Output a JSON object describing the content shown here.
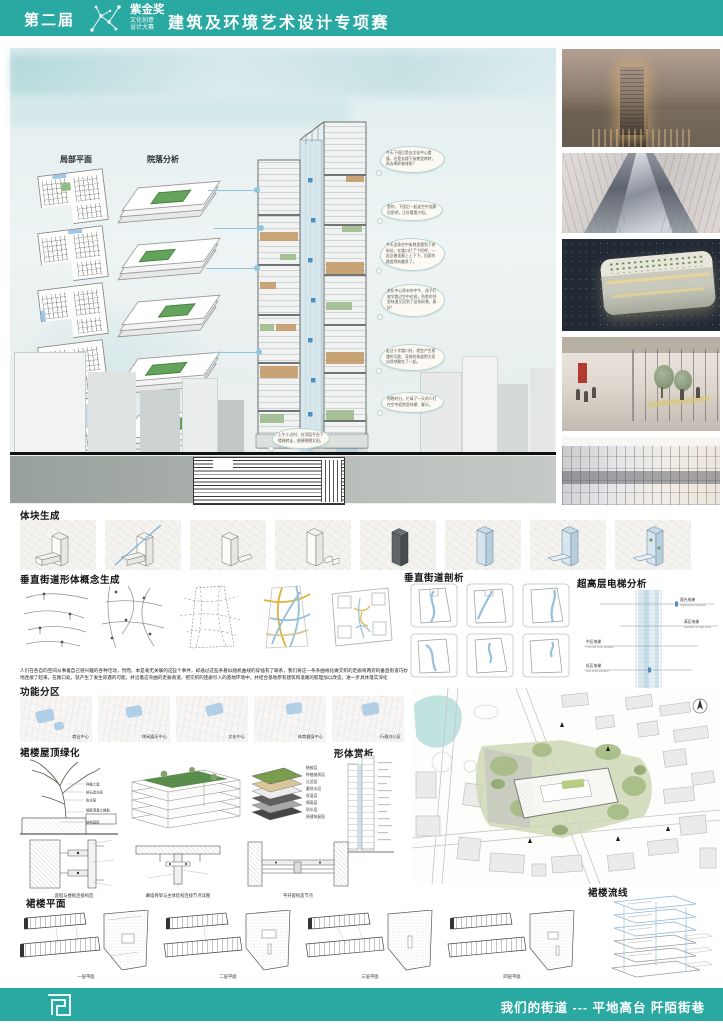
{
  "header": {
    "edition": "第二届",
    "award_name": "紫金奖",
    "award_line1": "文化创意",
    "award_line2": "设计大赛",
    "competition_title": "建筑及环境艺术设计专项赛"
  },
  "board": {
    "partial_plan_label": "局部平面",
    "courtyard_label": "院落分析",
    "bubbles": [
      "今天下班后是去文化中心看展，还是去楼下街巷里转转，再去喝杯咖啡呢？",
      "是的，下班后一起走空中连廊回家吧，正好看看夕阳。",
      "今天这条空中街巷里遇到了老街坊，在路口打了个招呼，一起沿着连廊上上下下，回家的路变得有趣多了。",
      "文化中心周末的中午，孩子们放学路过空中花园，熟悉的邻里味道又回到了这条街巷，真好！",
      "走过十字路口处，就会产生相遇的可能，弯曲的甬道把大家自然地聚在了一起。",
      "傍晚时分，忙碌了一天的人们在空中庭院里休憩、聊天。",
      "上午十点时，在顶层平台下楼梯转走，顺便晒晒太阳。"
    ]
  },
  "massing": {
    "title": "体块生成"
  },
  "concept": {
    "title": "垂直街道形体概念生成"
  },
  "street_section": {
    "title": "垂直街道剖析"
  },
  "elevator": {
    "title": "超高层电梯分析",
    "labels": [
      {
        "cn": "观光电梯",
        "en": "Sightseeing elevator"
      },
      {
        "cn": "高区电梯",
        "en": "Elevator for high zone"
      },
      {
        "cn": "中区电梯",
        "en": "The mid zone elevator"
      },
      {
        "cn": "低区电梯",
        "en": "Low zone elevator"
      }
    ]
  },
  "narrative": "人们在各自的空间从事着自己感兴趣的各种活动，然而，本是毫无关联的这些个事件，却通过这些条看似随机曲线的穿插有了联系，我们将这一条条曲线化做交织的走廊将两旁的垂直街道巧妙地连接了起来，在路口处，就产生了发生际遇的可能，并沿着这弯曲的走廊甬道，把交织的连廊引入的基地环境中，并结合基地原有建筑和道路的肌理加以改造，进一步具体落实深化",
  "function_zones": {
    "title": "功能分区",
    "zones": [
      "商业中心",
      "休闲娱乐中心",
      "文化中心",
      "体育健身中心",
      "行政办公区"
    ]
  },
  "roof_green": {
    "title": "裙楼屋顶绿化",
    "tree_labels": [
      "种植土壤",
      "卵石滤水层",
      "防水层",
      "钢筋混凝土楼板",
      "结构基层"
    ],
    "layer_labels": [
      "植被层",
      "种植基质层",
      "过滤层",
      "蓄排水层",
      "保温层",
      "隔离层",
      "防水层",
      "原建筑屋面"
    ],
    "detail_captions": [
      "竖梃与楼板连接构造",
      "幕墙骨架与主体结构连接节点详图",
      "平开窗构造节点"
    ]
  },
  "form_review": {
    "title": "形体赏析"
  },
  "podium_plans": {
    "title": "裙楼平面",
    "labels": [
      "一层平面",
      "二层平面",
      "三层平面",
      "四层平面"
    ]
  },
  "circulation": {
    "title": "裙楼流线"
  },
  "footer": {
    "slogan": "我们的街道 --- 平地高台 阡陌街巷"
  },
  "colors": {
    "accent_teal": "#2aa9a2",
    "connector_blue": "#8ec6de",
    "ribbon_blue": "#84b6d6"
  }
}
